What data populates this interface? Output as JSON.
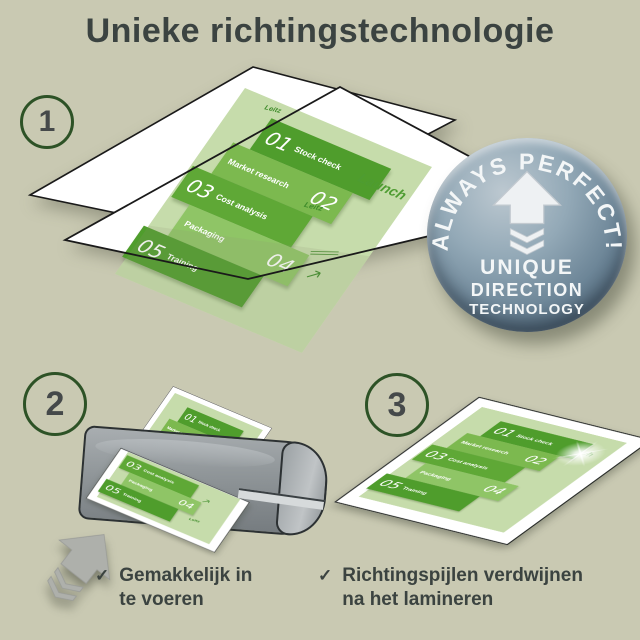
{
  "title": "Unieke richtingstechnologie",
  "steps": {
    "one": "1",
    "two": "2",
    "three": "3"
  },
  "badge": {
    "arc_text": "ALWAYS PERFECT!",
    "line1": "UNIQUE",
    "line2": "DIRECTION",
    "line3": "TECHNOLOGY"
  },
  "document": {
    "launch_label": "Launch",
    "watermark_label": "Leitz",
    "bands": [
      {
        "num": "01",
        "label": "Stock check"
      },
      {
        "num": "02",
        "label": "Market research"
      },
      {
        "num": "03",
        "label": "Cost analysis"
      },
      {
        "num": "04",
        "label": "Packaging"
      },
      {
        "num": "05",
        "label": "Training"
      }
    ]
  },
  "captions": {
    "check": "✓",
    "step2_line1": "Gemakkelijk in",
    "step2_line2": "te voeren",
    "step3_line1": "Richtingspijlen verdwijnen",
    "step3_line2": "na het lamineren"
  },
  "colors": {
    "background": "#c9c9b2",
    "text": "#3b4341",
    "circle_ring": "#2d5226",
    "green_dark": "#4f9d2c",
    "green_mid": "#7cb94f",
    "green_mid2": "#5fa836",
    "green_light": "#8fc566",
    "doc_background": "#c6dcab",
    "badge_steel": "#6b8496",
    "laminator_gray": "#8f9598",
    "pouch_white": "#ffffff"
  }
}
